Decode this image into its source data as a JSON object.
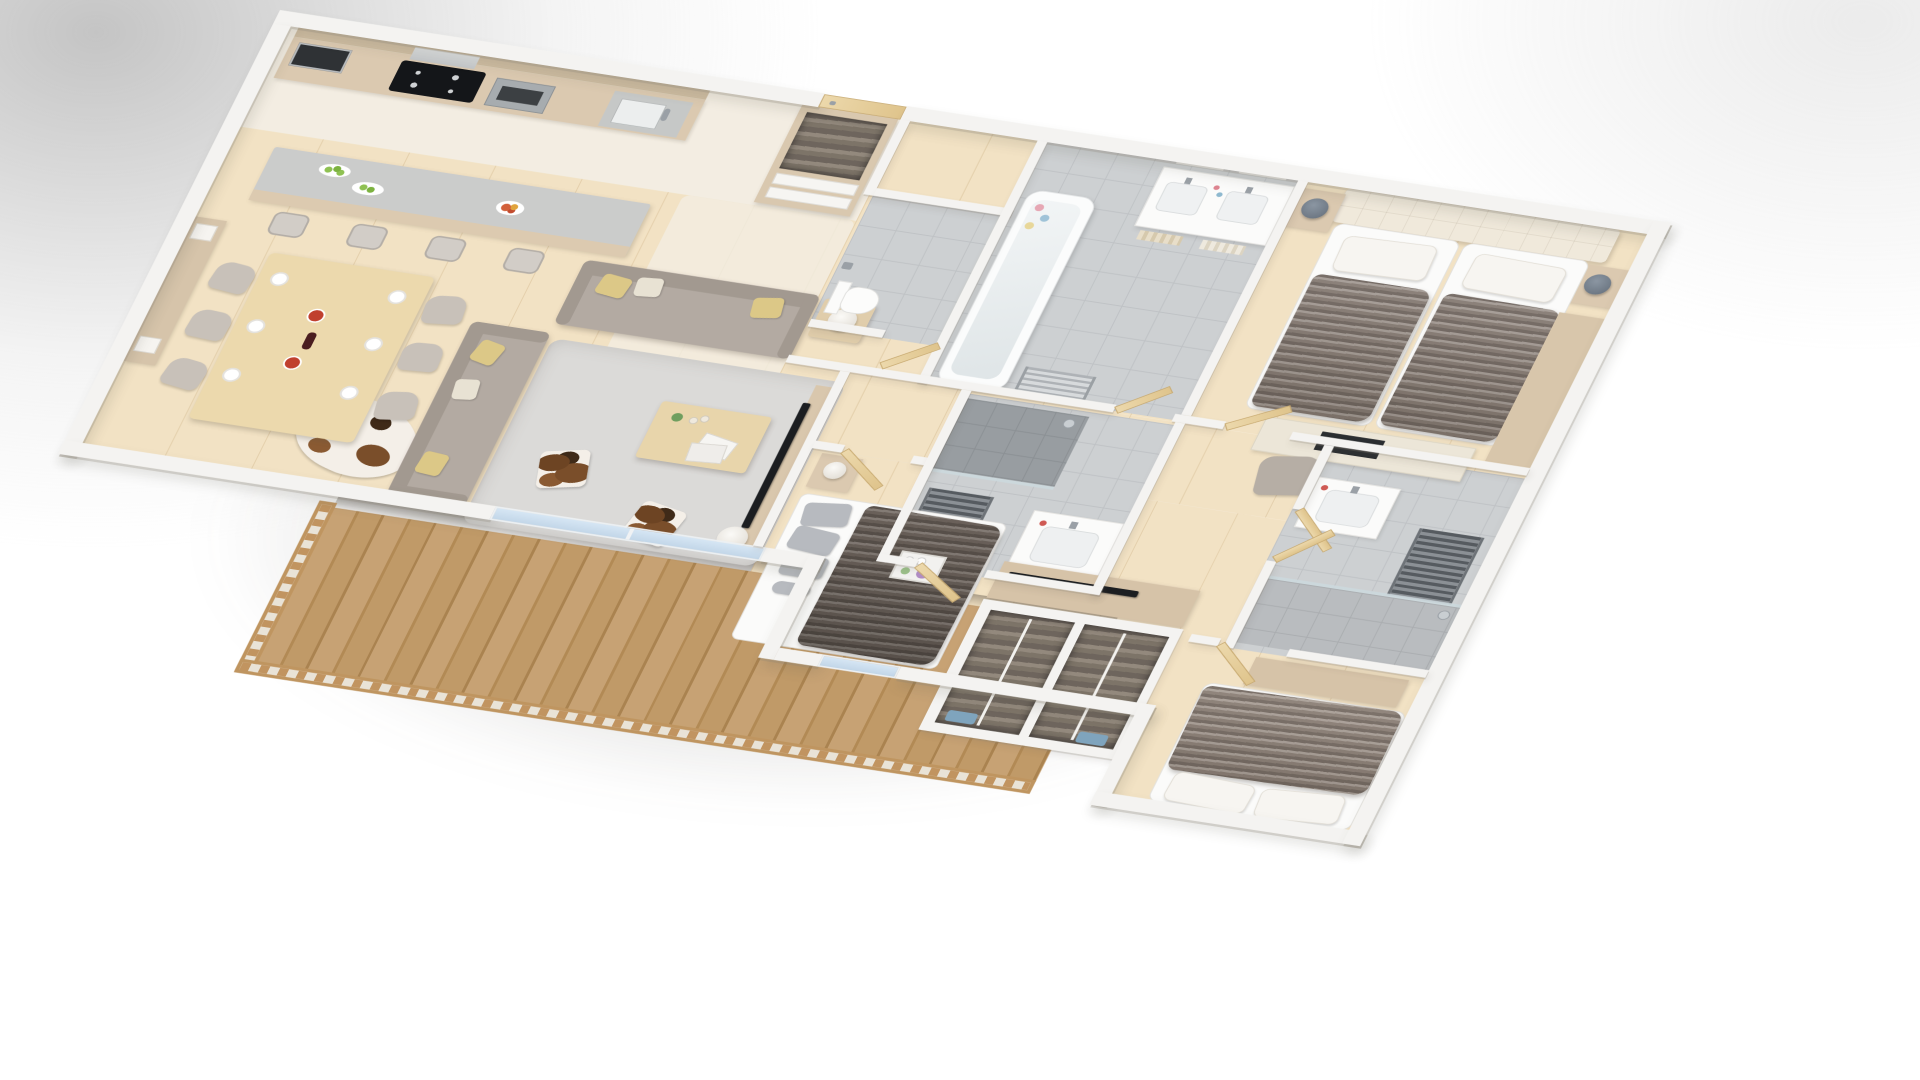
{
  "scene": {
    "title": "3D apartment floor-plan render",
    "view": "rotated bird's-eye axonometric cutaway",
    "background": "white with soft gray vignette",
    "floors": "light oak wood, gray tile in wet rooms, marble-white kitchen strip"
  },
  "palette": {
    "wall": "#f4f3f1",
    "wood-floor": "#f2e2c4",
    "floor-light": "#f3ede2",
    "tile": "#cdd0d2",
    "cabinet-wood": "#dbc9b0",
    "door-wood": "#e7d2a6",
    "counter": "#c9cac8",
    "sofa": "#b3aaa2",
    "cushion-yellow": "#dcc887",
    "rug": "#dbdad8",
    "fur": "#8f857d",
    "headboard": "#f0e9db",
    "deck-wood": "#c7a274",
    "glass-blue": "#cfe2f2",
    "tv-black": "#1c1e21",
    "lamp-gray": "#707a86",
    "apple-green": "#8fc152",
    "fruit-red": "#d2603a",
    "wine-dark": "#4a1d1f",
    "flower-purple": "#b08cc4"
  },
  "rooms": {
    "kitchen": {
      "name": "Kitchen",
      "items": [
        "wood cabinet run",
        "built-in microwave",
        "induction cooktop",
        "extractor hood",
        "oven",
        "sink with faucet",
        "breakfast island with gray counter",
        "4 bar stools",
        "2 plates of green apples",
        "fruit bowl"
      ]
    },
    "dining": {
      "name": "Dining area",
      "items": [
        "table set for 6",
        "6 upholstered chairs",
        "6 white plates",
        "2 red dishes",
        "wine bottle",
        "sideboard",
        "2 white table lamps",
        "wall art",
        "cowhide rug"
      ]
    },
    "living": {
      "name": "Living room",
      "items": [
        "2 gray fabric sofas",
        "yellow and cream cushions",
        "side table with white lamp",
        "gray shag rug",
        "wood coffee table",
        "green bottle and glasses",
        "magazines",
        "2 cowhide cube ottomans",
        "TV on media board",
        "white floor lamp"
      ]
    },
    "balcony": {
      "name": "Balcony",
      "items": [
        "wood plank deck",
        "slatted wood railing",
        "sliding glass doors"
      ]
    },
    "entry": {
      "name": "Entry hall",
      "items": [
        "wood front door",
        "open coat closet with jackets",
        "shoe shelves"
      ]
    },
    "wc": {
      "name": "Guest WC",
      "items": [
        "wall-hung toilet",
        "toilet-paper holder",
        "gray tiled walls and floor"
      ]
    },
    "bathroom": {
      "name": "Main bathroom",
      "items": [
        "bathtub with bath pearls",
        "double vanity with 2 sinks",
        "2 mirrors",
        "toiletries",
        "towels on shelf",
        "towel radiator"
      ]
    },
    "master": {
      "name": "Master bedroom",
      "items": [
        "cream tufted headboard wall",
        "2 single beds with fur throws",
        "white pillows",
        "2 wood nightstands",
        "2 gray lamps",
        "desk with dark inset",
        "desk chair",
        "tall wood dresser"
      ]
    },
    "shower_mid": {
      "name": "Shower room (center)",
      "items": [
        "dark tiled walk-in shower",
        "glass panel",
        "towel radiator",
        "washbasin vanity"
      ]
    },
    "shower_right": {
      "name": "Shower room (right)",
      "items": [
        "glass walk-in shower",
        "towel radiator",
        "washbasin vanity"
      ]
    },
    "bedroom2": {
      "name": "Bedroom 2",
      "items": [
        "double bed with white linen",
        "3 gray pillows",
        "dark fur throw",
        "breakfast tray with flowers",
        "nightstand with lamp",
        "sideboard with TV",
        "blue window"
      ]
    },
    "wardrobes": {
      "name": "Wardrobe nook",
      "items": [
        "2 open wardrobes",
        "rows of hanging clothes",
        "center rails"
      ]
    },
    "bedroom3": {
      "name": "Bedroom 3",
      "items": [
        "double bed with fur blanket",
        "2 white pillows",
        "wood foot bench"
      ]
    },
    "hallway": {
      "name": "Hallway",
      "items": [
        "multiple light-wood doors ajar",
        "chrome handles"
      ]
    }
  }
}
